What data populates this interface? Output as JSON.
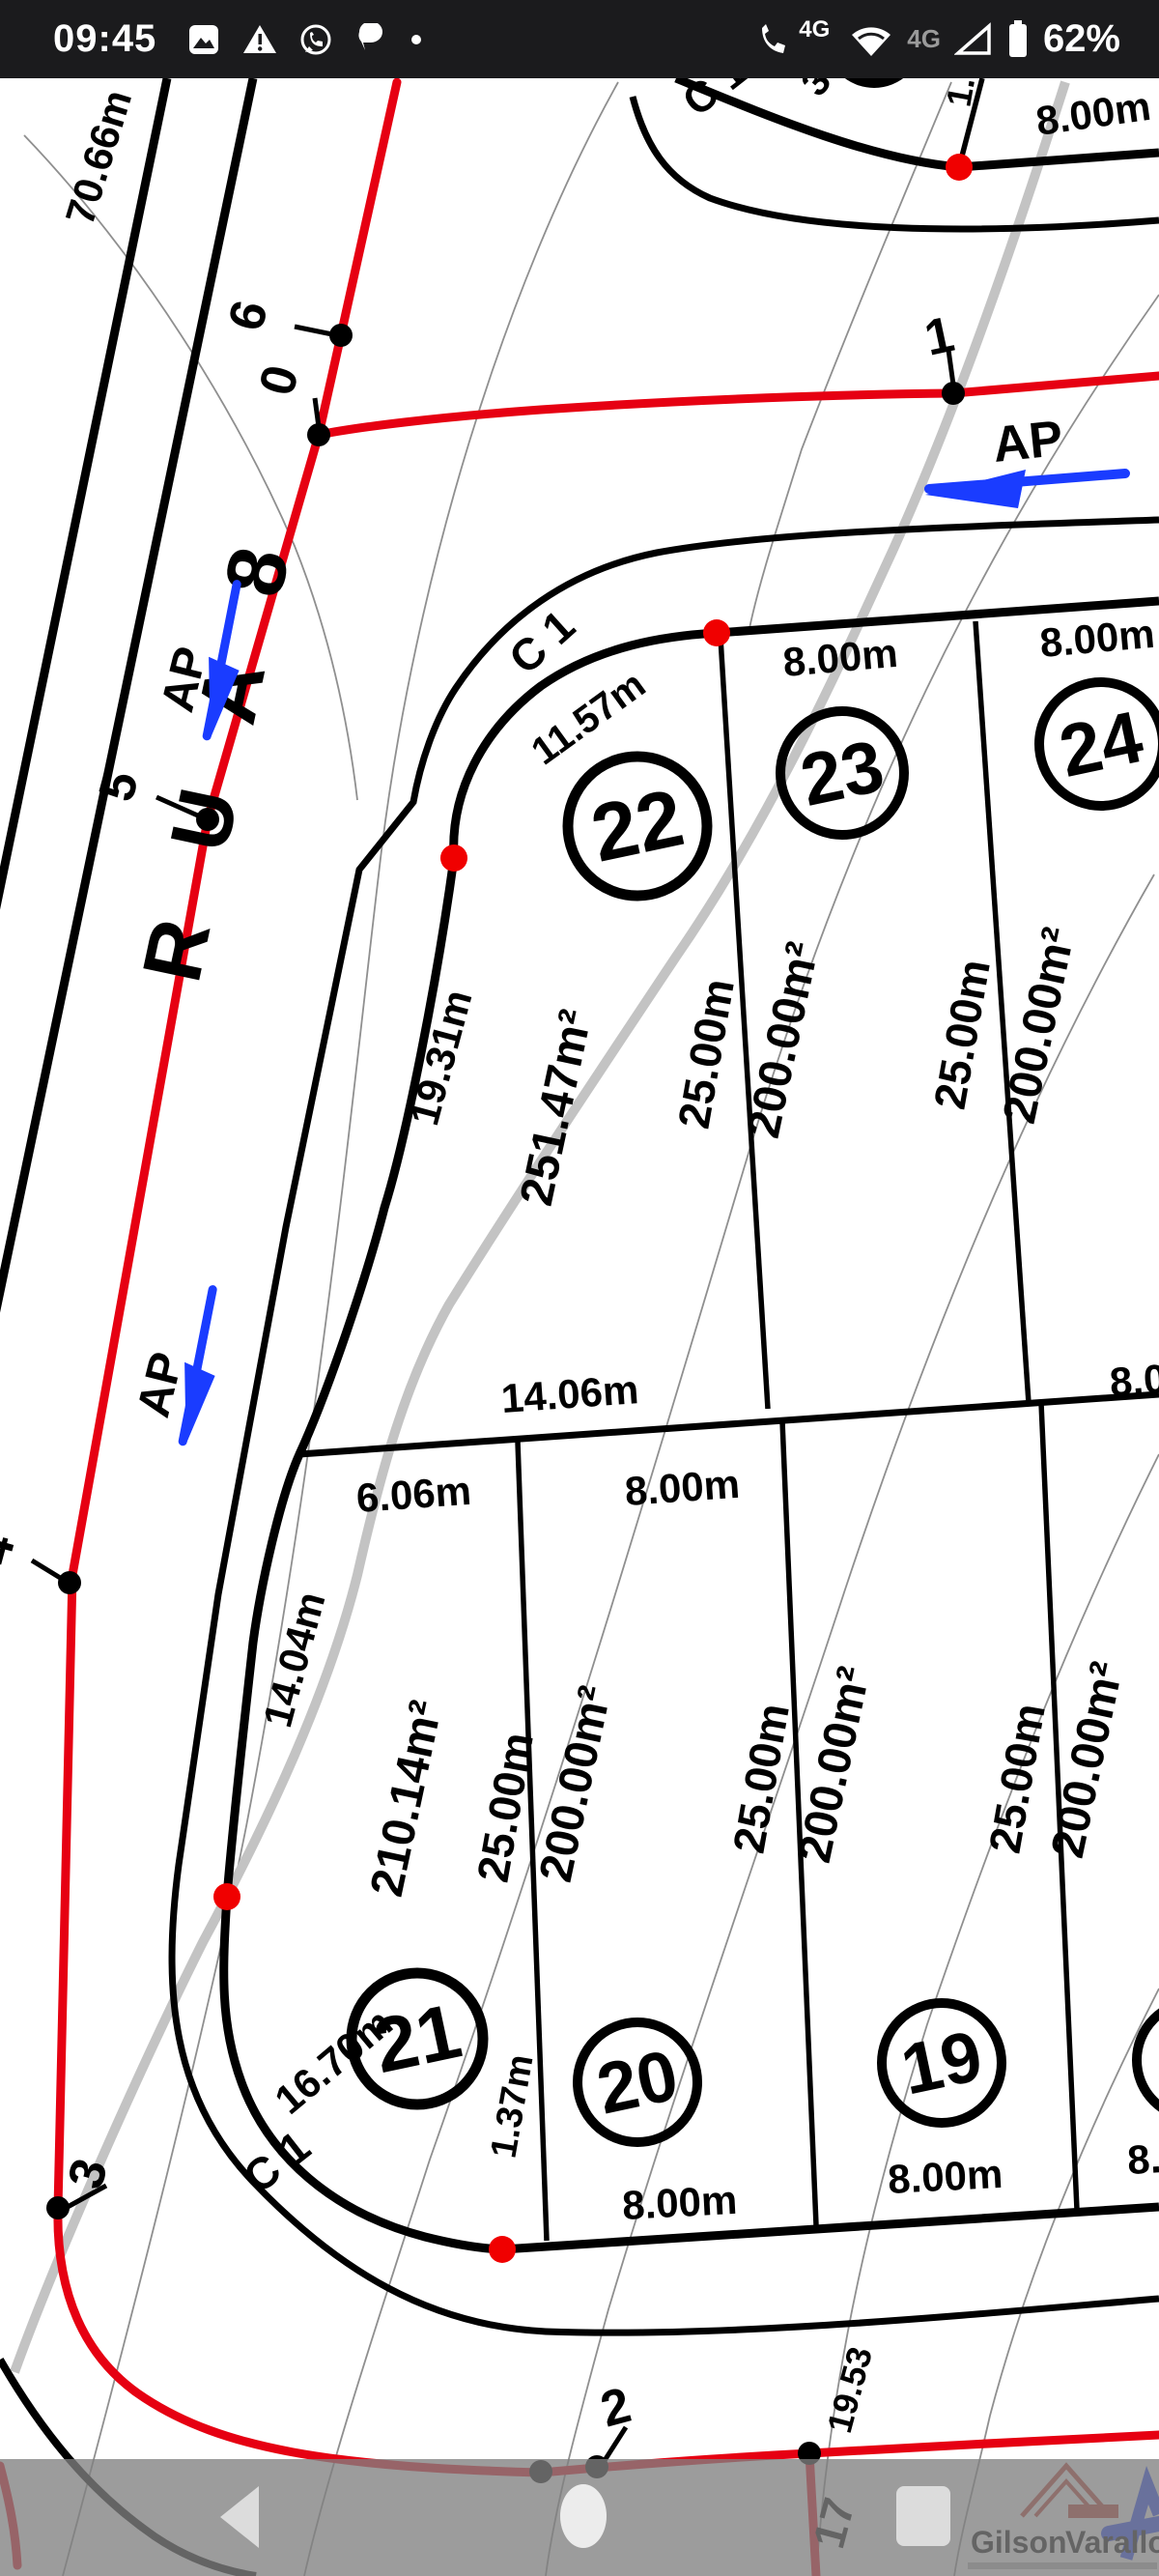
{
  "status_bar": {
    "time": "09:45",
    "volte_badge": "4G",
    "network_badge": "4G",
    "battery_percent": "62%"
  },
  "map": {
    "street_name": "R U A 8",
    "ap_label": "AP",
    "curve_label": "C 1",
    "boundary_length_top_left": "70.66m",
    "dims": {
      "d1157": "11.57m",
      "d1931": "19.31m",
      "d1406": "14.06m",
      "d606": "6.06m",
      "d1404": "14.04m",
      "d1670": "16.70m",
      "d137": "1.37m",
      "d800": "8.00m",
      "d80_frag": "8.0",
      "d8_frag": "8.",
      "d2500": "25.00m",
      "d1953": "19.53",
      "frag_3": "3",
      "frag_10": "1.0"
    },
    "lots": [
      {
        "number": "22",
        "area": "251.47m²"
      },
      {
        "number": "23",
        "area": "200.00m²"
      },
      {
        "number": "24",
        "area": "200.00m²"
      },
      {
        "number": "21",
        "area": "210.14m²"
      },
      {
        "number": "20",
        "area": "200.00m²"
      },
      {
        "number": "19",
        "area": "200.00m²"
      },
      {
        "area": "200.00m²"
      }
    ],
    "survey_points": {
      "p6": "6",
      "p0": "0",
      "p1": "1",
      "p5": "5",
      "p4": "4",
      "p3": "3",
      "p2": "2",
      "p17": "17"
    }
  },
  "watermark": {
    "first_name": "Gilson",
    "last_name": "Varallo"
  }
}
